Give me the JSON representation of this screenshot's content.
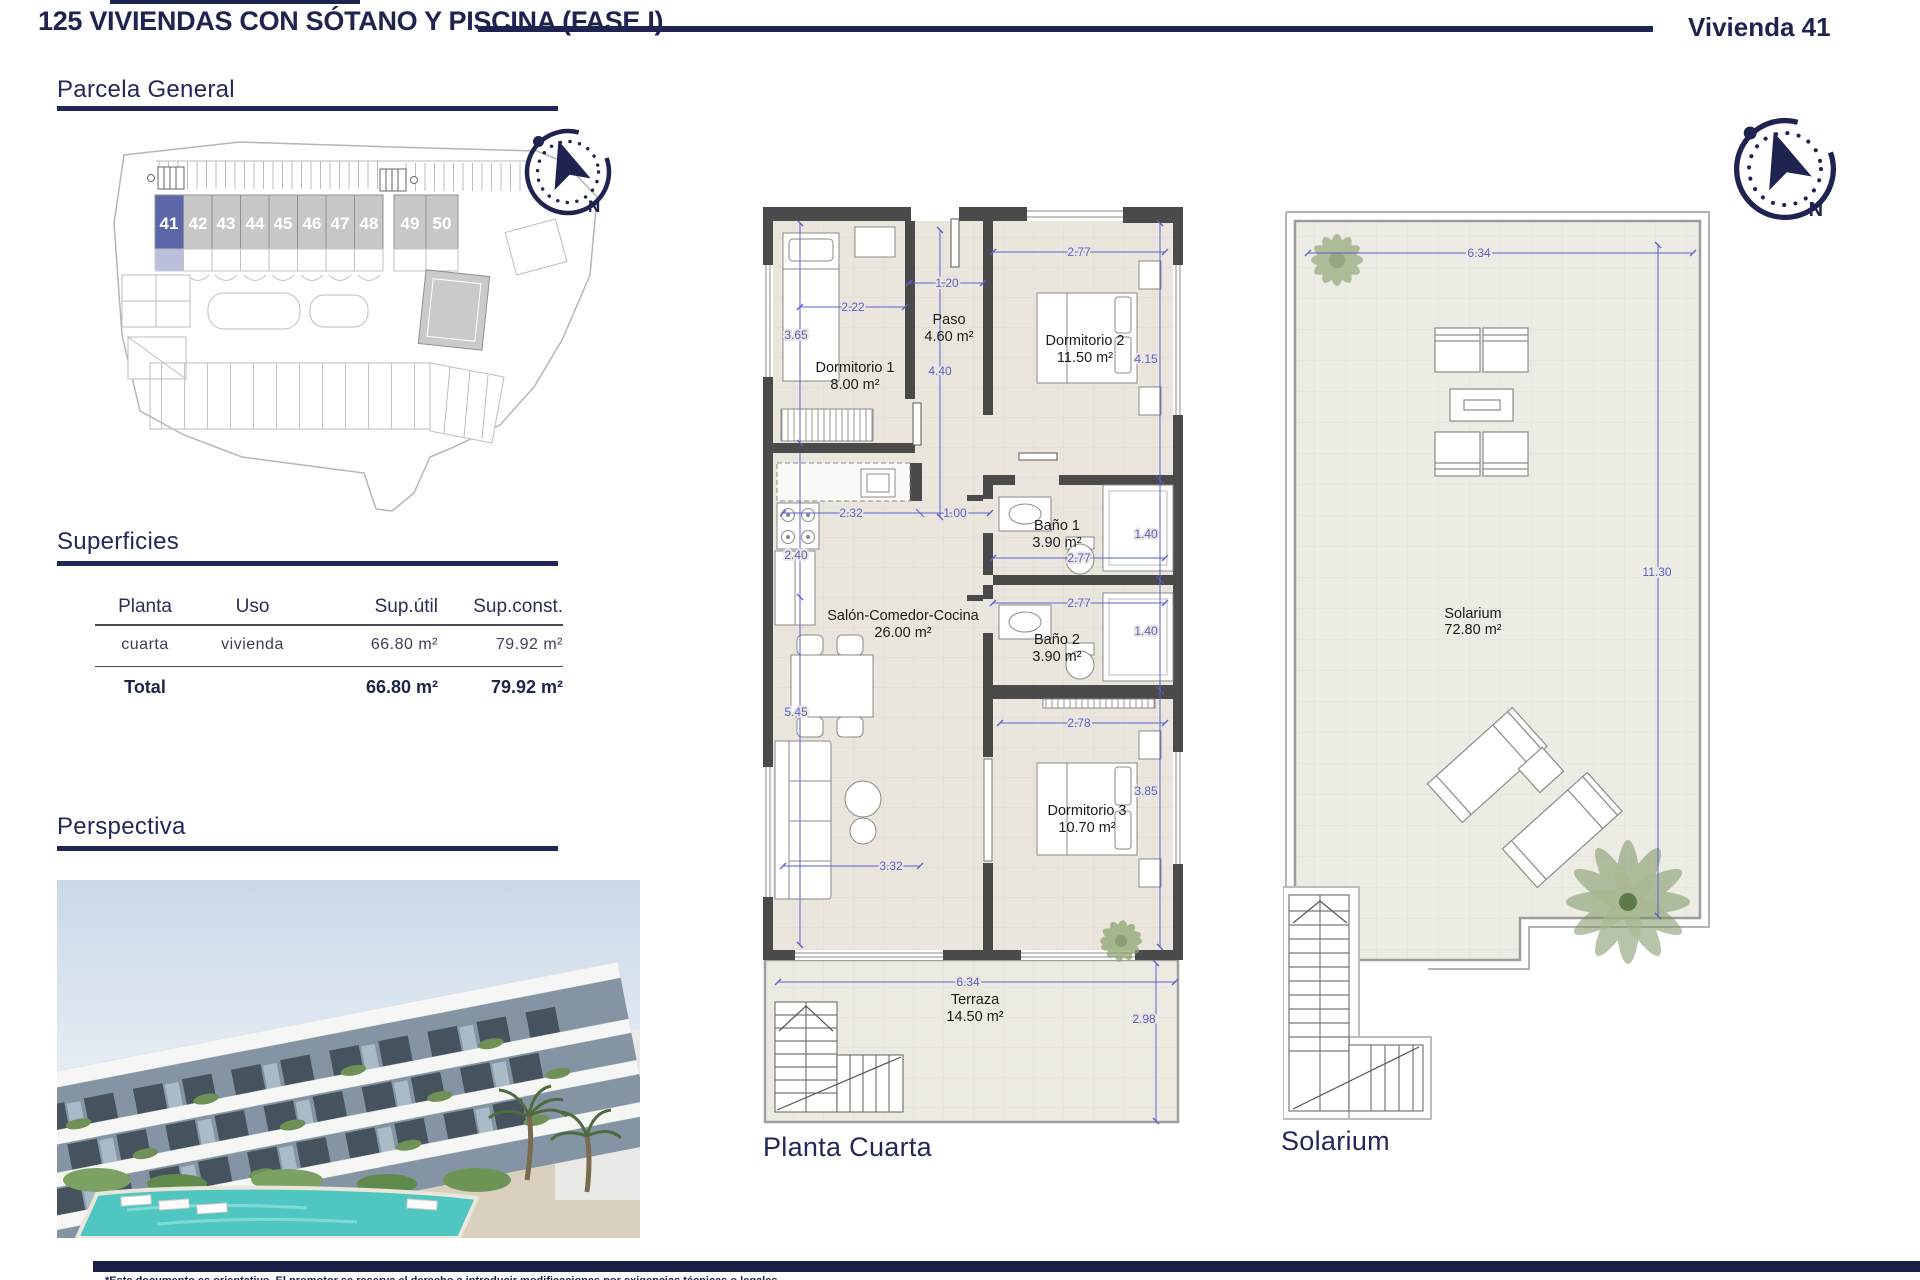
{
  "header": {
    "title": "125 VIVIENDAS CON SÓTANO Y PISCINA (FASE I)",
    "unit": "Vivienda 41"
  },
  "sections": {
    "parcela": "Parcela General",
    "superficies": "Superficies",
    "perspectiva": "Perspectiva"
  },
  "site_plan": {
    "highlighted": "41",
    "units": [
      "41",
      "42",
      "43",
      "44",
      "45",
      "46",
      "47",
      "48",
      "49",
      "50"
    ]
  },
  "table": {
    "headers": [
      "Planta",
      "Uso",
      "Sup.útil",
      "Sup.const."
    ],
    "row": {
      "planta": "cuarta",
      "uso": "vivienda",
      "util": "66.80 m²",
      "const": "79.92 m²"
    },
    "total": {
      "label": "Total",
      "util": "66.80 m²",
      "const": "79.92 m²"
    }
  },
  "plan": {
    "caption": "Planta Cuarta",
    "rooms": {
      "dorm1": {
        "name": "Dormitorio 1",
        "area": "8.00 m²"
      },
      "paso": {
        "name": "Paso",
        "area": "4.60 m²"
      },
      "dorm2": {
        "name": "Dormitorio 2",
        "area": "11.50 m²"
      },
      "bano1": {
        "name": "Baño 1",
        "area": "3.90 m²"
      },
      "bano2": {
        "name": "Baño 2",
        "area": "3.90 m²"
      },
      "salon": {
        "name": "Salón-Comedor-Cocina",
        "area": "26.00 m²"
      },
      "dorm3": {
        "name": "Dormitorio 3",
        "area": "10.70 m²"
      },
      "terraza": {
        "name": "Terraza",
        "area": "14.50 m²"
      }
    },
    "dims": {
      "d365": "3.65",
      "d222": "2.22",
      "d120": "1.20",
      "d440": "4.40",
      "d277a": "2.77",
      "d415": "4.15",
      "d232": "2.32",
      "d100": "1.00",
      "d240": "2.40",
      "d277b": "2.77",
      "d140a": "1.40",
      "d277c": "2.77",
      "d140b": "1.40",
      "d545": "5.45",
      "d332": "3.32",
      "d278": "2.78",
      "d385": "3.85",
      "d634": "6.34",
      "d298": "2.98"
    }
  },
  "solarium": {
    "caption": "Solarium",
    "room": {
      "name": "Solarium",
      "area": "72.80 m²"
    },
    "dims": {
      "d634": "6.34",
      "d1130": "11.30"
    }
  },
  "compass": {
    "north": "N"
  },
  "colors": {
    "navy": "#1e2350",
    "dim_blue": "#5a60ce",
    "wall": "#4a4a4a",
    "floor": "#eae6dd",
    "highlight_unit": "#5c67a9"
  },
  "footer": {
    "disclaimer": "*Este documento es orientativo. El promotor se reserva el derecho a introducir modificaciones por exigencias técnicas o legales."
  }
}
